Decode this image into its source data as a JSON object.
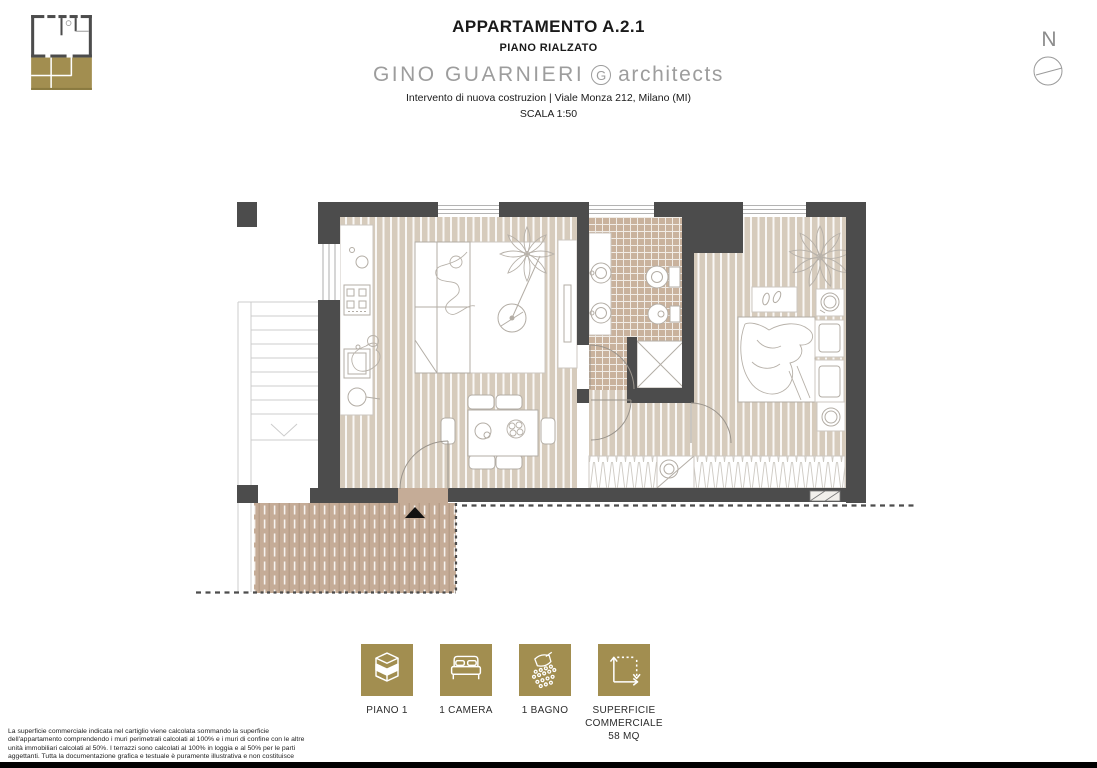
{
  "header": {
    "title": "APPARTAMENTO A.2.1",
    "subtitle": "PIANO RIALZATO",
    "firm": {
      "name": "GINO GUARNIERI",
      "mark": "G",
      "suffix": "architects"
    },
    "project_line": "Intervento di nuova costruzion | Viale Monza 212, Milano (MI)",
    "scale_line": "SCALA 1:50",
    "north_label": "N"
  },
  "plan": {
    "colors": {
      "wall": "#4c4c4c",
      "wood_floor": "#d6cbbc",
      "bath_tile": "#c9b29d",
      "terrace": "#c5ac97",
      "furniture_line": "#b3ada5"
    }
  },
  "legend": {
    "accent_color": "#a28e50",
    "items": [
      {
        "icon": "floor-stack-icon",
        "label": "PIANO 1"
      },
      {
        "icon": "bed-icon",
        "label": "1 CAMERA"
      },
      {
        "icon": "shower-icon",
        "label": "1 BAGNO"
      },
      {
        "icon": "area-dimensions-icon",
        "label": "SUPERFICIE COMMERCIALE 58 MQ"
      }
    ]
  },
  "footer": {
    "disclaimer": "La superficie commerciale indicata nel cartiglio viene calcolata sommando la superficie dell'appartamento comprendendo i muri perimetrali calcolati al 100% e i muri di confine con le altre unità immobiliari calcolati al 50%. I terrazzi sono calcolati al 100% in loggia e al 50% per le parti aggettanti. Tutta la documentazione grafica e testuale è puramente illustrativa e non costituisce vincolo contrattuale."
  }
}
